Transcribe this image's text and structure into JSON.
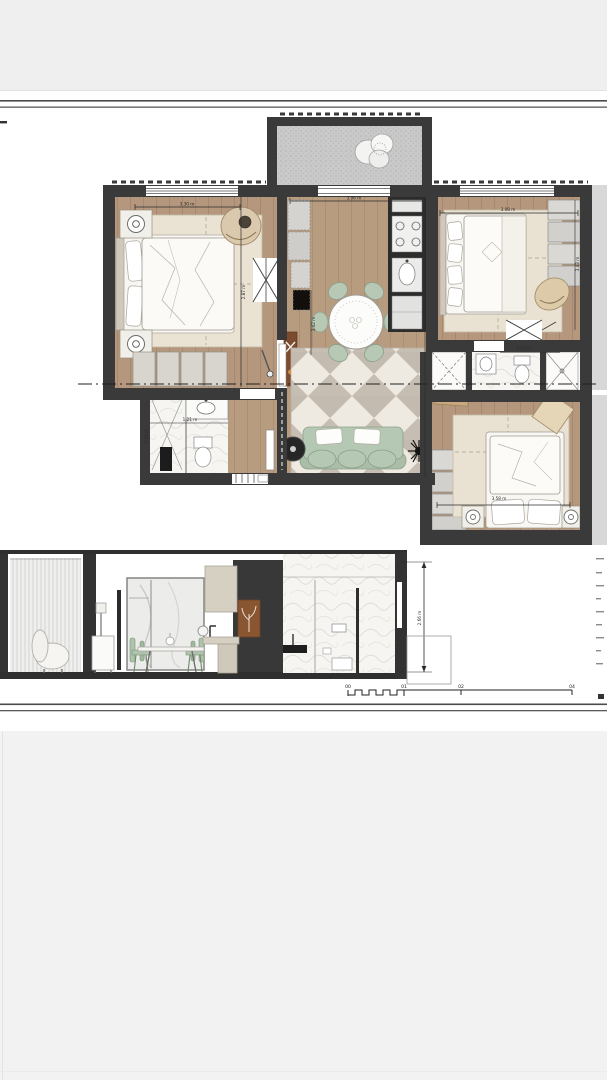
{
  "plan": {
    "dims": {
      "bedroom1_w": "3.30 m",
      "bedroom1_d": "2.87 m",
      "living_w": "3.96 m",
      "living_d": "3.42 m",
      "bedroom2_w": "3.08 m",
      "bedroom2_d": "3.43 m",
      "bath2_w": "1.57 m",
      "bath1_w": "1.21 m",
      "bath1_d": "1.51 m",
      "bedroom3_w": "3.58 m"
    }
  },
  "section": {
    "height_dim": "2.66 m"
  },
  "scale_bar": {
    "l0": "00",
    "l1": "01",
    "l2": "02",
    "l3": "04"
  }
}
